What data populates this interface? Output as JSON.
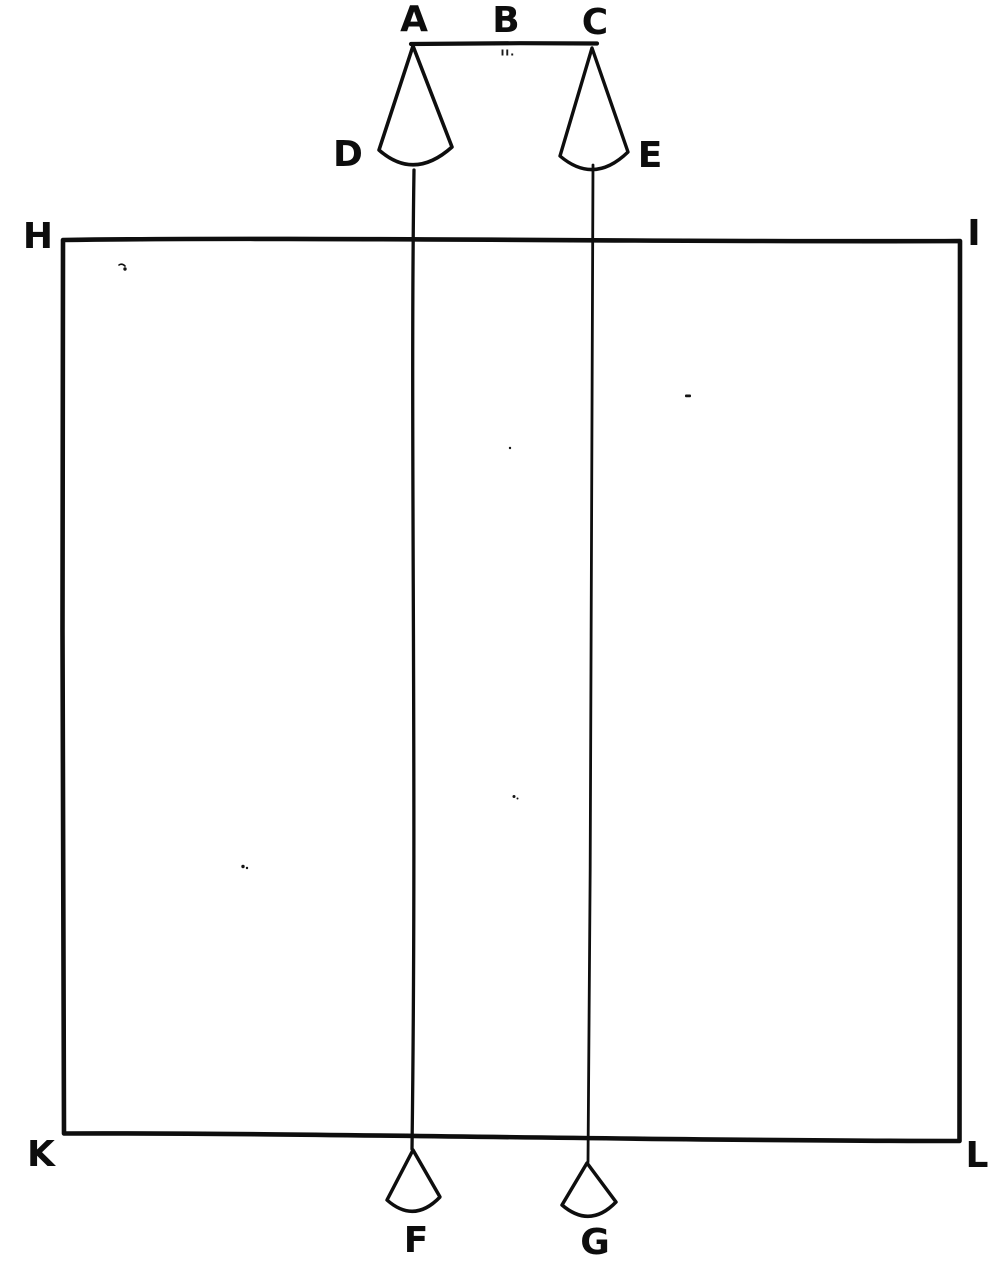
{
  "colors": {
    "ink": "#0e0e0e",
    "paper": "#ffffff"
  },
  "labels": {
    "A": "A",
    "B": "B",
    "C": "C",
    "D": "D",
    "E": "E",
    "F": "F",
    "G": "G",
    "H": "H",
    "I": "I",
    "K": "K",
    "L": "L"
  },
  "marks": {
    "beam_midpoint": "ıı."
  }
}
